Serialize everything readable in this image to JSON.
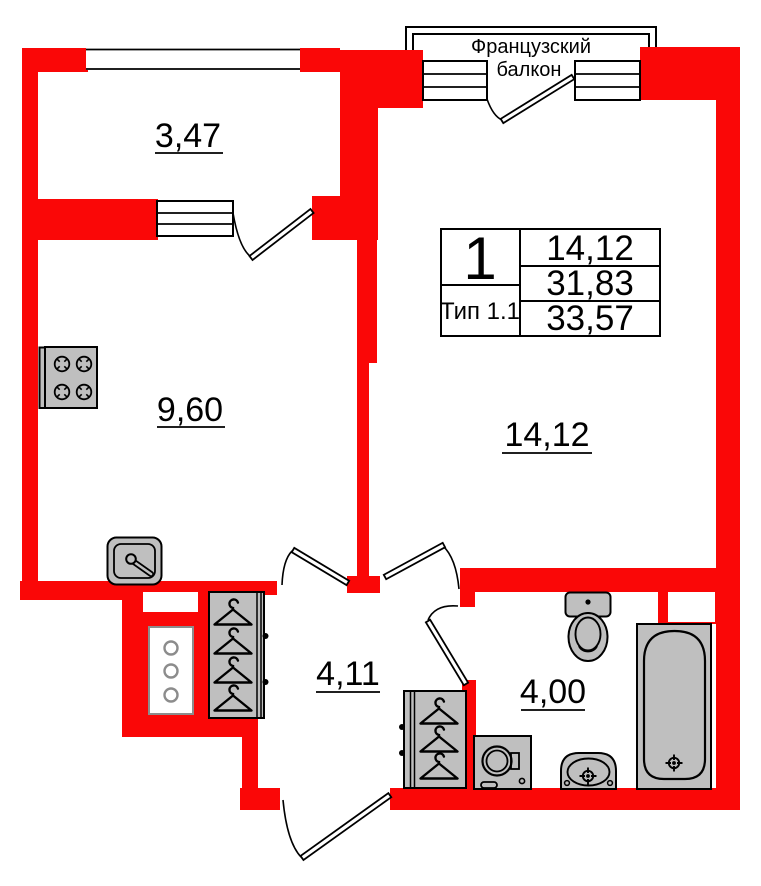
{
  "balcony_banner": {
    "line1": "Французский",
    "line2": "балкон"
  },
  "rooms": {
    "loggia": {
      "area": "3,47"
    },
    "kitchen": {
      "area": "9,60"
    },
    "living": {
      "area": "14,12"
    },
    "hall": {
      "area": "4,11"
    },
    "bath": {
      "area": "4,00"
    }
  },
  "info_table": {
    "rooms_count": "1",
    "type": "Тип 1.1",
    "living_area": "14,12",
    "area_without_balcony": "31,83",
    "total_area": "33,57"
  },
  "colors": {
    "wall": "#fa0707",
    "furniture_fill": "#bfbfbf",
    "vent_stroke": "#8c8c8c"
  }
}
